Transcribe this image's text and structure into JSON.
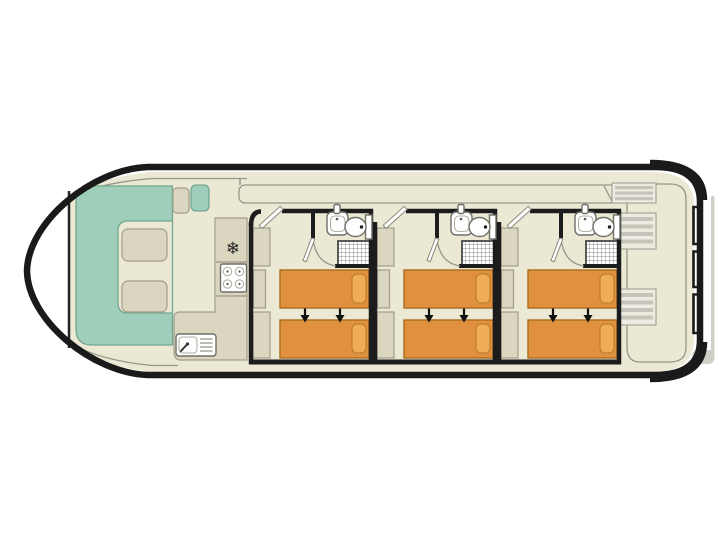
{
  "diagram": {
    "title": "Houseboat deck plan",
    "type": "boat-floor-plan",
    "view": "top-down"
  },
  "icons": {
    "fridge_glyph": "❄"
  },
  "colors": {
    "background": "#ffffff",
    "hull": "#1a1a1a",
    "wall": "#1c1c1c",
    "floor": "#ebe8d4",
    "thin_line": "#98968a",
    "furniture": "#dbd6bf",
    "furniture_border": "#a29e8b",
    "seating": "#9fceba",
    "seating_border": "#74a78f",
    "bed": "#e0903e",
    "bed_border": "#a96d1e",
    "pillow": "#f1ac58",
    "pillow_border": "#bb8030",
    "fixture_border": "#6f6f68",
    "shower_grid": "#8e8e86",
    "arrow": "#111111",
    "shadow": "#cfcfc8"
  },
  "areas": {
    "bow_saloon": {
      "label": "Bow saloon",
      "seating": "U-shaped bench",
      "tables": 2,
      "side_seats": 2
    },
    "galley": {
      "label": "Galley",
      "equipment": [
        "fridge",
        "4-burner hob",
        "sink with drainer"
      ]
    },
    "walkway": {
      "label": "Side walkway"
    },
    "stern_deck": {
      "label": "Stern deck",
      "step_units": 3
    },
    "cabins": [
      {
        "label": "Cabin 1",
        "beds": 2,
        "bed_arrangement": "twin beds, slide together",
        "ensuite": [
          "washbasin",
          "toilet",
          "shower"
        ],
        "wardrobes": 3
      },
      {
        "label": "Cabin 2",
        "beds": 2,
        "bed_arrangement": "twin beds, slide together",
        "ensuite": [
          "washbasin",
          "toilet",
          "shower"
        ],
        "wardrobes": 3
      },
      {
        "label": "Cabin 3",
        "beds": 2,
        "bed_arrangement": "twin beds, slide together",
        "ensuite": [
          "washbasin",
          "toilet",
          "shower"
        ],
        "wardrobes": 3
      }
    ]
  }
}
